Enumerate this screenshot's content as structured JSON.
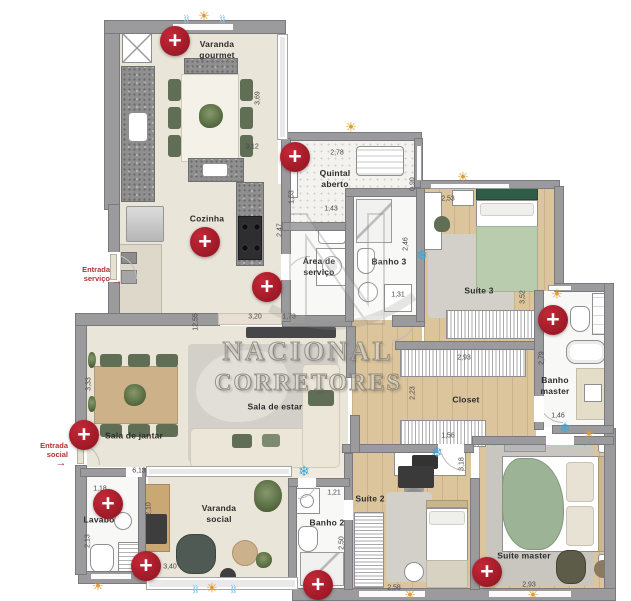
{
  "colors": {
    "marker_red": "#9c1926",
    "sun_gold": "#df9d33",
    "snow_blue": "#3da6da",
    "entrance_red": "#b23431",
    "wall_gray": "#9b9b9d",
    "wood": "#dcc59c",
    "beige": "#eae5d9"
  },
  "watermark": {
    "line1": "NACIONAL",
    "line2": "CORRETORES"
  },
  "icon_glyphs": {
    "sun": "☀",
    "snowflake": "❄",
    "vent": "♒",
    "arrow": "→",
    "plus": "+"
  },
  "entrances": {
    "service": {
      "label": "Entrada\nserviço"
    },
    "social": {
      "label": "Entrada\nsocial"
    }
  },
  "rooms": {
    "varanda_gourmet": {
      "label": "Varanda\ngourmet"
    },
    "quintal_aberto": {
      "label": "Quintal\naberto"
    },
    "cozinha": {
      "label": "Cozinha"
    },
    "area_servico": {
      "label": "Área de\nserviço"
    },
    "banho3": {
      "label": "Banho 3"
    },
    "suite3": {
      "label": "Suíte 3"
    },
    "banho_master": {
      "label": "Banho\nmaster"
    },
    "closet": {
      "label": "Closet"
    },
    "sala_estar": {
      "label": "Sala de estar"
    },
    "sala_jantar": {
      "label": "Sala de jantar"
    },
    "lavabo": {
      "label": "Lavabo"
    },
    "varanda_social": {
      "label": "Varanda\nsocial"
    },
    "suite2": {
      "label": "Suíte 2"
    },
    "banho2": {
      "label": "Banho 2"
    },
    "suite_master": {
      "label": "Suíte master"
    }
  },
  "dims": [
    {
      "t": "3,69"
    },
    {
      "t": "3,12"
    },
    {
      "t": "2,78"
    },
    {
      "t": "1,53"
    },
    {
      "t": "0,90"
    },
    {
      "t": "1,43"
    },
    {
      "t": "2,53"
    },
    {
      "t": "2,47"
    },
    {
      "t": "2,46"
    },
    {
      "t": "1,31"
    },
    {
      "t": "12,55"
    },
    {
      "t": "3,20"
    },
    {
      "t": "1,73"
    },
    {
      "t": "3,52"
    },
    {
      "t": "2,79"
    },
    {
      "t": "1,46"
    },
    {
      "t": "2,93"
    },
    {
      "t": "2,23"
    },
    {
      "t": "1,56"
    },
    {
      "t": "3,18"
    },
    {
      "t": "3,33"
    },
    {
      "t": "6,13"
    },
    {
      "t": "1,18"
    },
    {
      "t": "2,13"
    },
    {
      "t": "2,10"
    },
    {
      "t": "3,40"
    },
    {
      "t": "1,21"
    },
    {
      "t": "2,50"
    },
    {
      "t": "2,58"
    },
    {
      "t": "2,93"
    }
  ]
}
